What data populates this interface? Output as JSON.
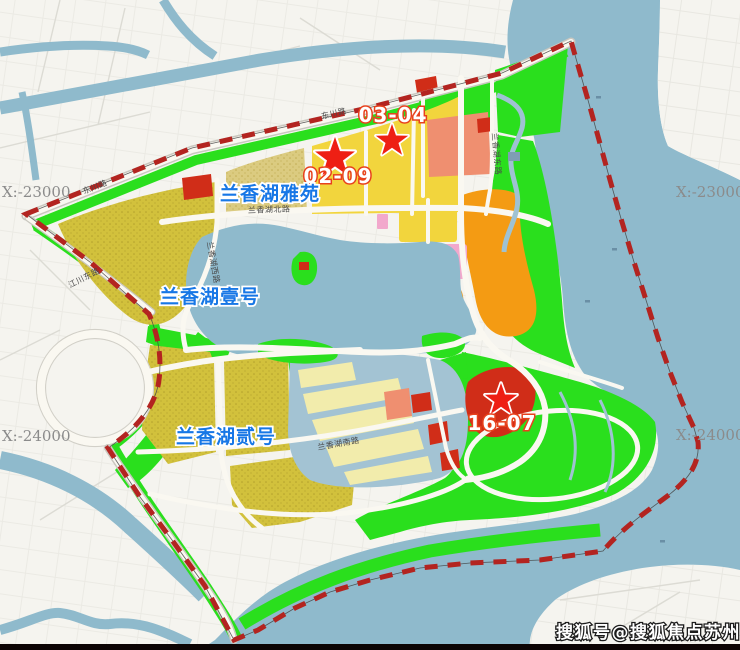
{
  "map": {
    "watermark": "搜狐号@搜狐焦点苏州站",
    "project_labels": [
      {
        "name": "lanxianghu-yayuan",
        "text": "兰香湖雅苑"
      },
      {
        "name": "lanxianghu-yihao",
        "text": "兰香湖壹号"
      },
      {
        "name": "lanxianghu-erhao",
        "text": "兰香湖贰号"
      }
    ],
    "plot_markers": [
      {
        "id": "02-09",
        "label": "02-09"
      },
      {
        "id": "03-04",
        "label": "03-04"
      },
      {
        "id": "16-07",
        "label": "16-07"
      }
    ],
    "coordinate_labels": {
      "top_left": "X:-23000",
      "top_right": "X:-23000",
      "bottom_left": "X:-24000",
      "bottom_right": "X:-24000"
    },
    "road_labels": [
      {
        "text": "东川路"
      },
      {
        "text": "东川路"
      },
      {
        "text": "江川东路"
      },
      {
        "text": "兰香湖北路"
      },
      {
        "text": "兰香湖西路"
      },
      {
        "text": "兰香湖东路"
      },
      {
        "text": "兰香湖南路"
      }
    ],
    "legend_colors": {
      "water": "#8fbacc",
      "creek": "#9fc2d2",
      "park_green": "#2adf1d",
      "residential_khaki": "#d2c13c",
      "residential_tan": "#dbcb80",
      "residential_yellow": "#f2d53d",
      "residential_cream": "#f2ecac",
      "commercial_orange": "#f49b13",
      "mixed_salmon": "#ef8f70",
      "mixed_pink": "#f2a8cc",
      "public_red": "#d02d18",
      "boundary_red": "#b32420",
      "star_red": "#ee1f14",
      "label_blue": "#1777e6",
      "background": "#f5f4ef"
    }
  }
}
